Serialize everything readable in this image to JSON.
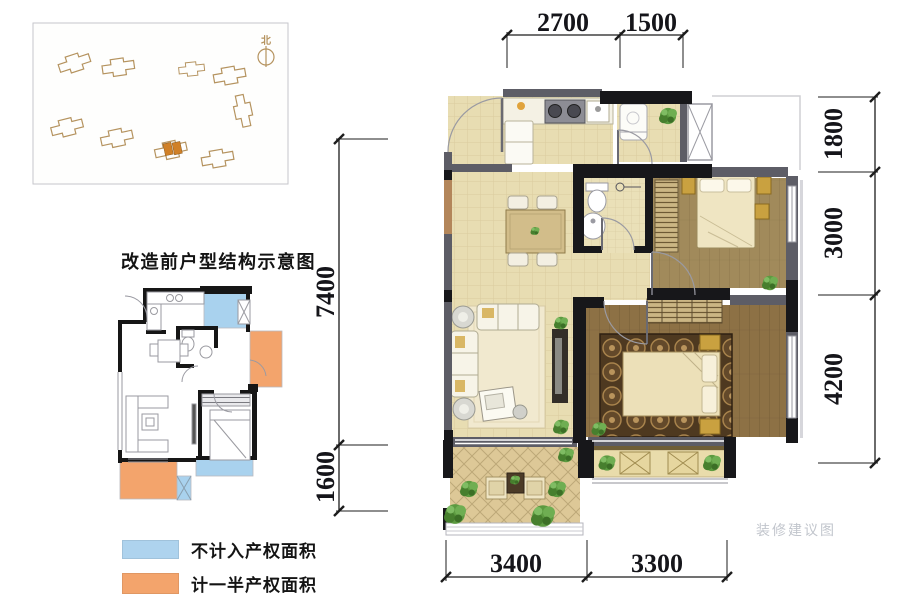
{
  "site_plan": {
    "north_label": "北"
  },
  "before_plan": {
    "title": "改造前户型结构示意图"
  },
  "legend": {
    "items": [
      {
        "label": "不计入产权面积",
        "color": "#aed3ee"
      },
      {
        "label": "计一半产权面积",
        "color": "#f3a46c"
      }
    ]
  },
  "main_plan": {
    "dims_top": [
      "2700",
      "1500"
    ],
    "dims_right": [
      "1800",
      "3000",
      "4200"
    ],
    "dims_left": [
      "7400",
      "1600"
    ],
    "dims_bottom": [
      "3400",
      "3300"
    ]
  },
  "watermark": {
    "text": "装修建议图"
  },
  "colors": {
    "site_highlight": "#d08027",
    "building_outline": "#b5935f",
    "blue_area": "#a9d2ee",
    "orange_area": "#f3a46c",
    "tile_floor": "#e8ddb2",
    "wood_floor_light": "#a18a5b",
    "wood_floor_dark": "#8d7145",
    "wall_black": "#17171a",
    "wall_gray": "#5d5d66",
    "dim_text": "#15151a"
  }
}
